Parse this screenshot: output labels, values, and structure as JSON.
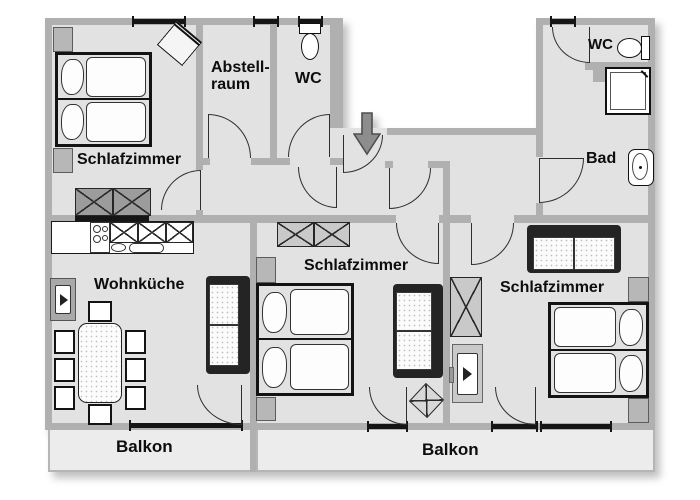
{
  "plan": {
    "type": "apartment-floor-plan",
    "labels": {
      "schlafzimmer_left": "Schlafzimmer",
      "abstellraum_line1": "Abstell-",
      "abstellraum_line2": "raum",
      "wc_top": "WC",
      "wc_bath": "WC",
      "bad": "Bad",
      "wohnkueche": "Wohnküche",
      "schlafzimmer_mid": "Schlafzimmer",
      "schlafzimmer_right": "Schlafzimmer",
      "balkon_left": "Balkon",
      "balkon_right": "Balkon"
    },
    "colors": {
      "background": "#ffffff",
      "floor": "#e2e2e2",
      "balcony_floor": "#ececec",
      "wall": "#b0b0b0",
      "outline": "#1a1a1a",
      "dark_furniture": "#242424",
      "wardrobe_dark": "#9c9c9c",
      "wardrobe_light": "#c9c9c9",
      "entrance_arrow": "#8d8d8d",
      "label_text": "#0d0d0d"
    },
    "icons": {
      "entrance": "entrance-arrow-icon",
      "toilets": [
        "toilet-icon",
        "toilet-icon"
      ],
      "shower": "shower-icon",
      "sink": "sink-icon",
      "stove": "stove-icon",
      "tvs": [
        "tv-icon",
        "tv-icon"
      ]
    }
  }
}
